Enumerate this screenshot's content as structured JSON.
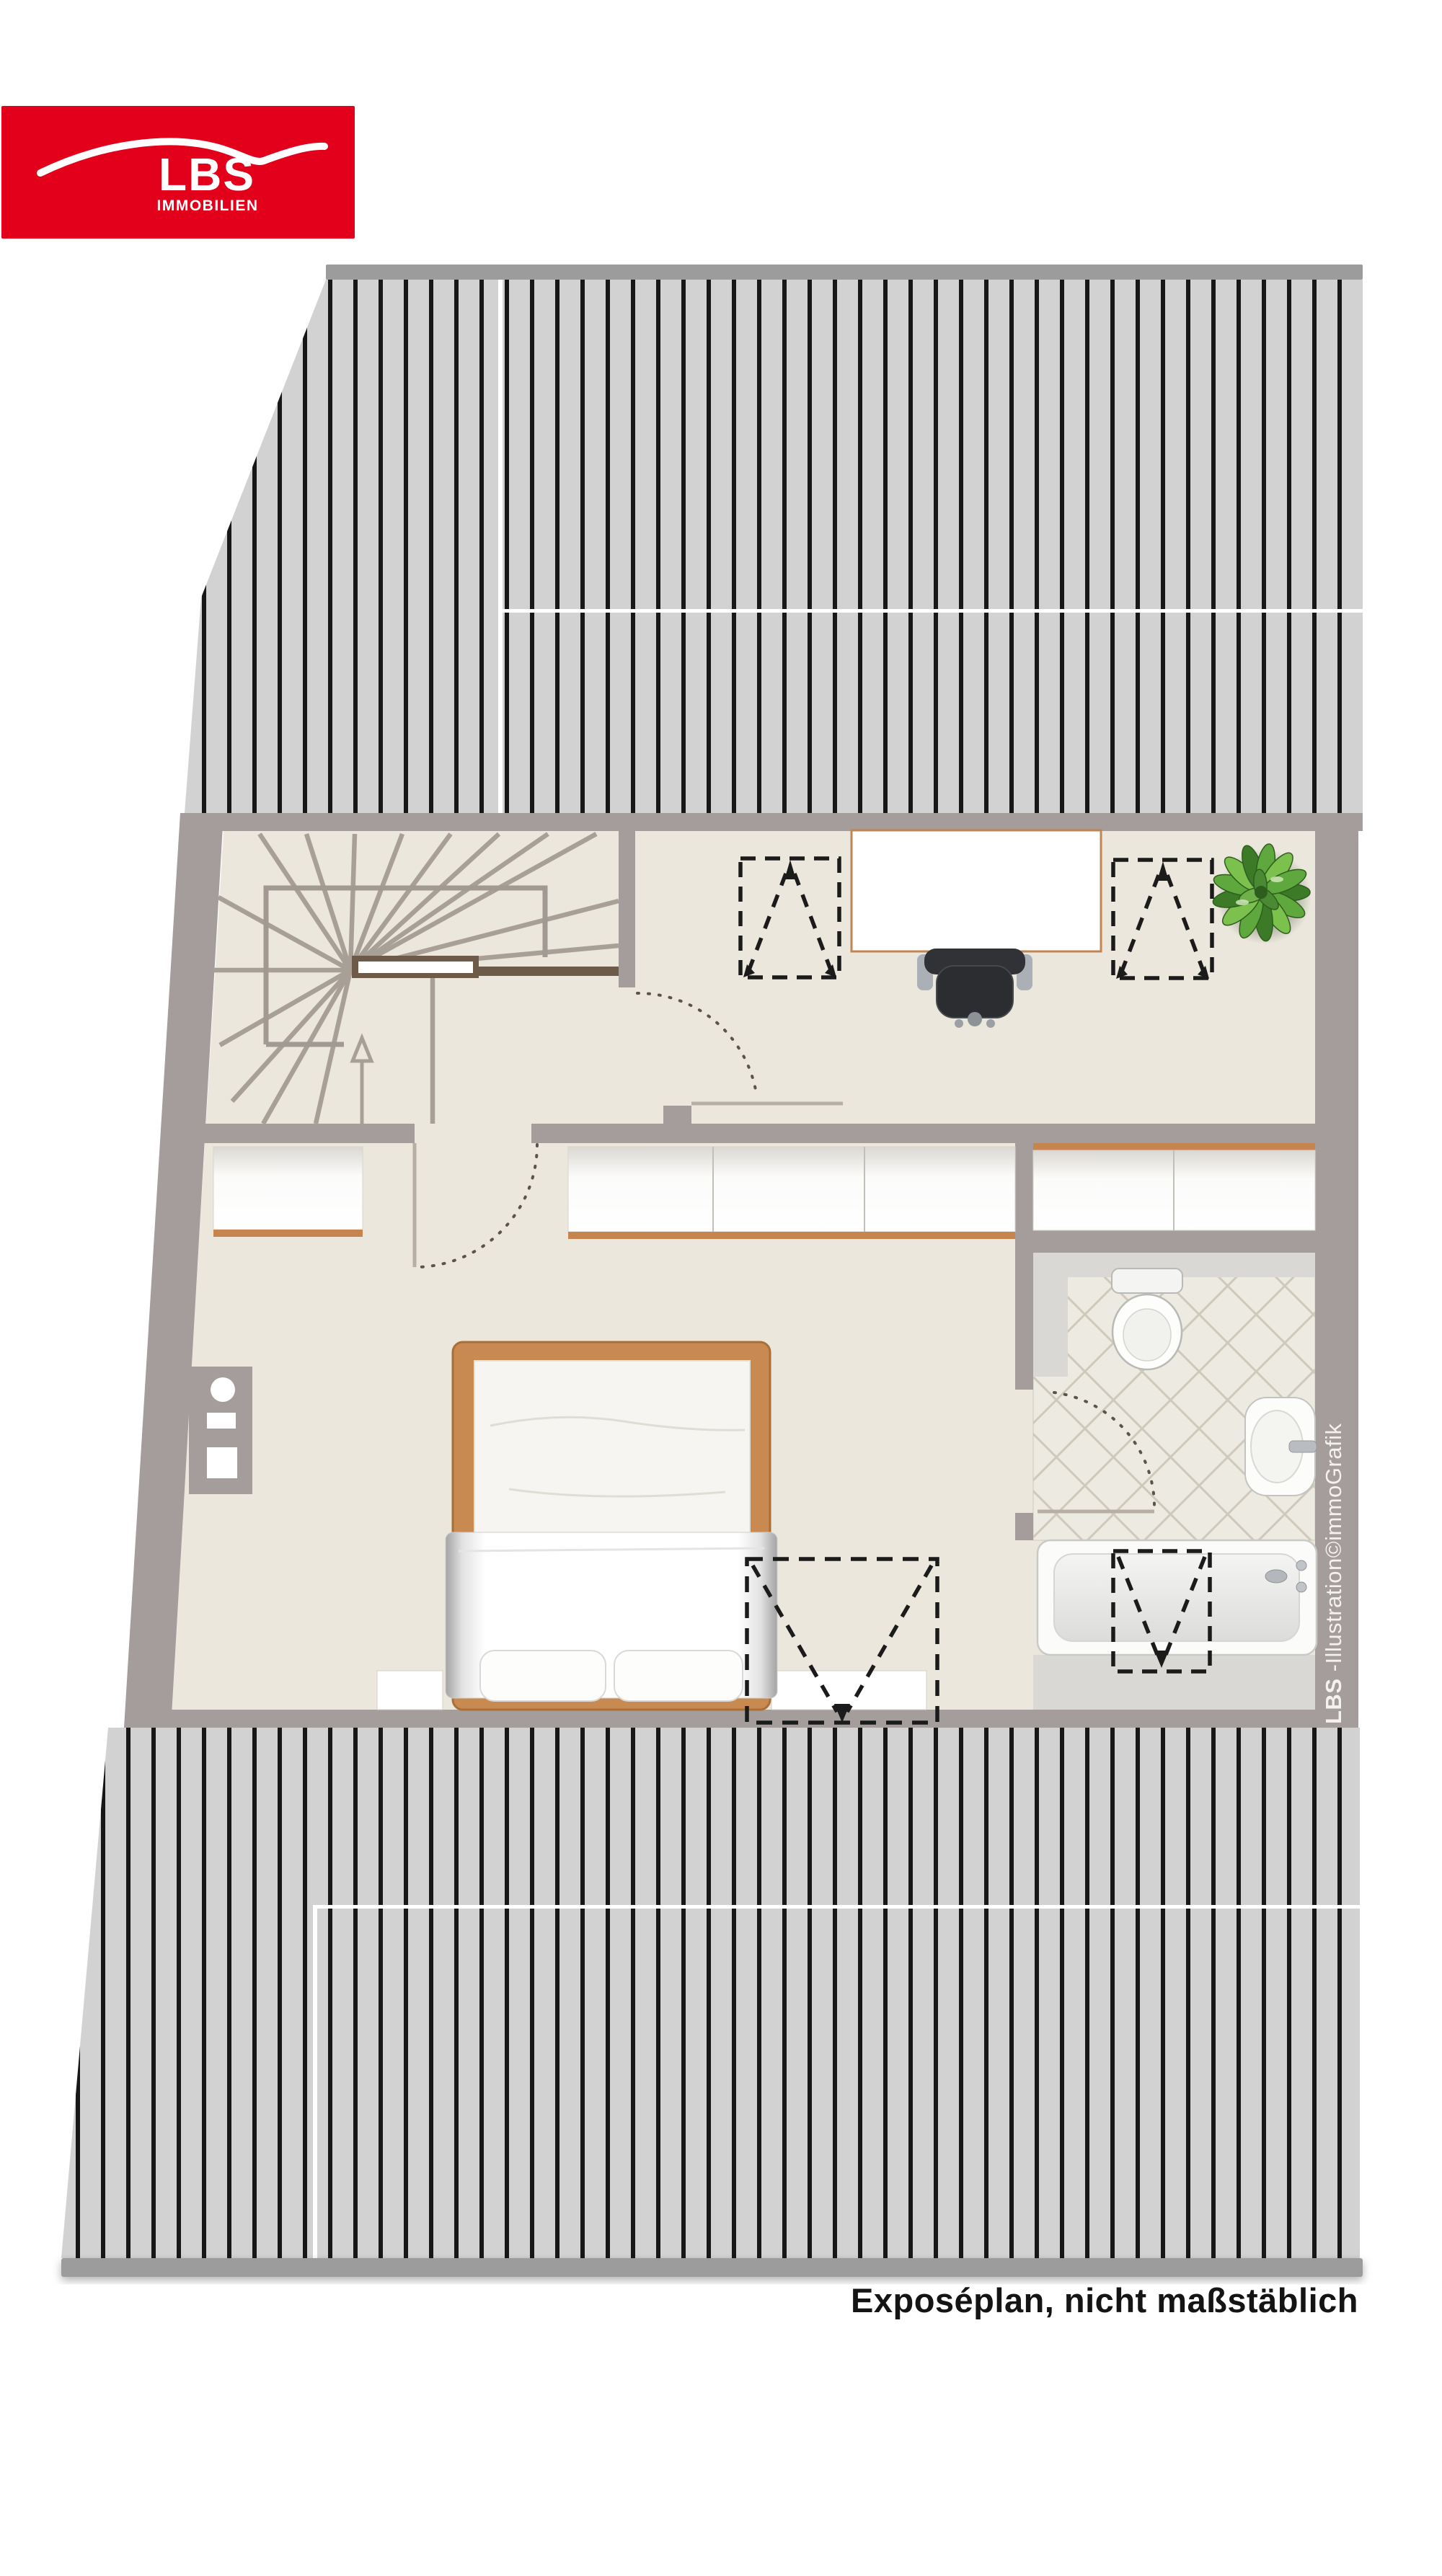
{
  "logo": {
    "brand": "LBS",
    "sub": "IMMOBILIEN",
    "bg_color": "#e2001a",
    "text_color": "#ffffff"
  },
  "caption": "Exposéplan, nicht maßstäblich",
  "credit": {
    "bold": "LBS",
    "rest": "-Illustration©immoGrafik"
  },
  "colors": {
    "wall_taupe": "#a59c9c",
    "floor_cream": "#ece7dc",
    "roof_plank": "#d2d2d2",
    "roof_line": "#171717",
    "roof_bar": "#9c9c9c",
    "wood_trim": "#c6854e",
    "stair_edge_brown": "#6e5a49",
    "stair_tread": "#a8a096",
    "tile_floor": "#edeae1",
    "tile_line": "#cfc9bb",
    "bath_gray": "#d9d8d4",
    "chair_dark": "#2e3034",
    "plant_green_dark": "#3c7a28",
    "plant_green_light": "#7cc04e",
    "symbol_black": "#1b1b1b",
    "door_arc": "#5d5349"
  },
  "icons": [
    "plant-icon",
    "office-chair-icon",
    "bed-icon",
    "toilet-icon",
    "sink-icon",
    "bathtub-icon",
    "stairs-icon",
    "chimney-icon",
    "skylight-symbol",
    "door-swing-symbol"
  ]
}
